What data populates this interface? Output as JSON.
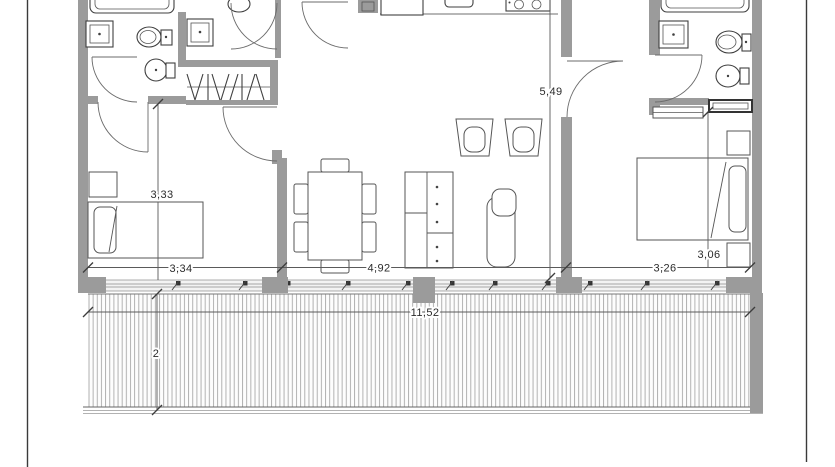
{
  "document": {
    "type": "architectural-floor-plan",
    "view": "top-down apartment plan with terrace, top edge cropped"
  },
  "dimensions": {
    "bedroom_left_depth": "3,33",
    "bedroom_left_width": "3,34",
    "living_width": "4,92",
    "interior_depth": "5,49",
    "bedroom_right_width": "3,26",
    "bedroom_right_depth": "3,06",
    "terrace_width": "11,52",
    "terrace_depth": "2"
  },
  "colors": {
    "wall": "#9b9b9b",
    "fixture_line": "#3f3f3f",
    "furniture_line": "#565656",
    "dimension_line": "#5a5a5a",
    "deck_hatch": "#a9a9a9",
    "label_text": "#2b2b2b",
    "background": "#ffffff"
  },
  "rooms": {
    "bathroom_left": {
      "fixtures": [
        "bathtub",
        "washbasin",
        "toilet",
        "bidet"
      ]
    },
    "hall_wc": {
      "fixtures": [
        "washbasin",
        "toilet"
      ]
    },
    "wardrobe": {
      "fixtures": [
        "hanging-rail",
        "clothes-hangers"
      ]
    },
    "kitchen": {
      "fixtures": [
        "counter",
        "sink",
        "cooktop",
        "column"
      ]
    },
    "living_dining": {
      "furniture": [
        "dining-table",
        "chairs",
        "sideboard",
        "lounge-chair",
        "armchairs"
      ]
    },
    "bedroom_left": {
      "furniture": [
        "single-bed",
        "nightstand"
      ]
    },
    "bedroom_right": {
      "furniture": [
        "double-bed",
        "nightstands",
        "low-shelf"
      ]
    },
    "bathroom_right": {
      "fixtures": [
        "bathtub",
        "washbasin",
        "toilet",
        "bidet",
        "cabinet"
      ]
    },
    "terrace": {
      "finish": "wood-decking"
    }
  }
}
